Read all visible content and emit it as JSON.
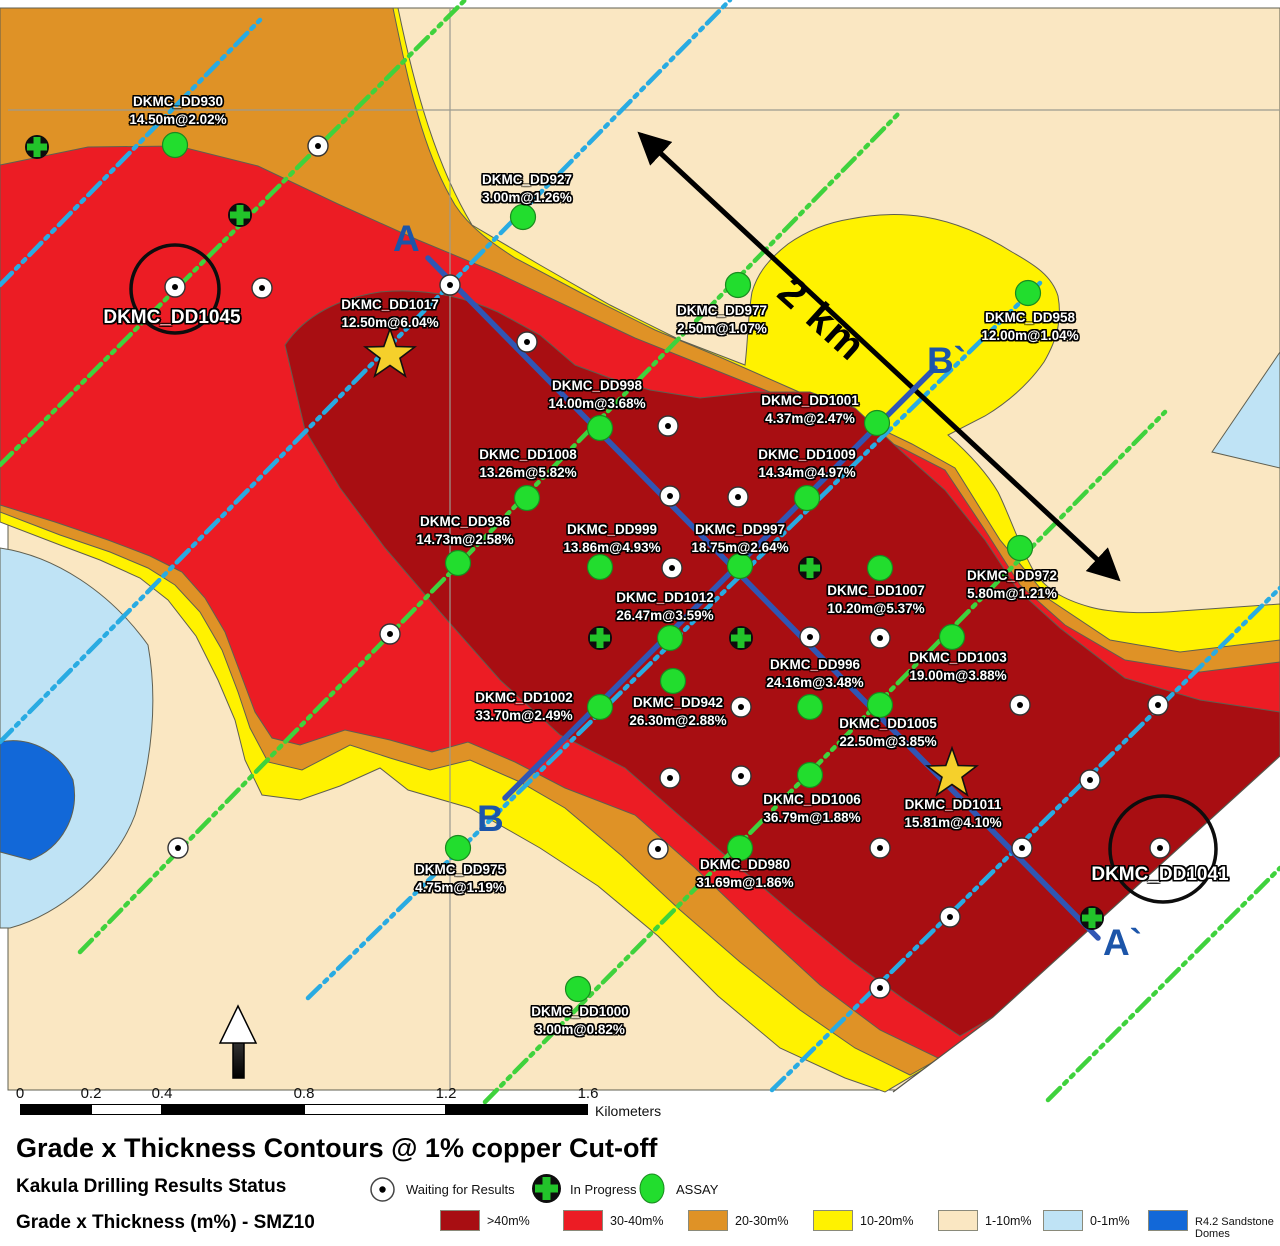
{
  "title": "Grade x Thickness Contours @ 1% copper Cut-off",
  "map": {
    "section_a": "A",
    "section_a_end": "A`",
    "section_b": "B",
    "section_b_end": "B`",
    "distance_label": "2 km"
  },
  "scalebar": {
    "ticks": [
      "0",
      "0.2",
      "0.4",
      "0.8",
      "1.2",
      "1.6"
    ],
    "unit": "Kilometers"
  },
  "holes": [
    {
      "id": "DKMC_DD930",
      "value": "14.50m@2.02%",
      "status": "assay"
    },
    {
      "id": "DKMC_DD927",
      "value": "3.00m@1.26%",
      "status": "assay"
    },
    {
      "id": "DKMC_DD977",
      "value": "2.50m@1.07%",
      "status": "assay"
    },
    {
      "id": "DKMC_DD958",
      "value": "12.00m@1.04%",
      "status": "assay"
    },
    {
      "id": "DKMC_DD1017",
      "value": "12.50m@6.04%",
      "status": "star"
    },
    {
      "id": "DKMC_DD1045",
      "value": "",
      "status": "waiting"
    },
    {
      "id": "DKMC_DD998",
      "value": "14.00m@3.68%",
      "status": "assay"
    },
    {
      "id": "DKMC_DD1001",
      "value": "4.37m@2.47%",
      "status": "assay"
    },
    {
      "id": "DKMC_DD1008",
      "value": "13.26m@5.82%",
      "status": "assay"
    },
    {
      "id": "DKMC_DD1009",
      "value": "14.34m@4.97%",
      "status": "assay"
    },
    {
      "id": "DKMC_DD936",
      "value": "14.73m@2.58%",
      "status": "assay"
    },
    {
      "id": "DKMC_DD999",
      "value": "13.86m@4.93%",
      "status": "assay"
    },
    {
      "id": "DKMC_DD997",
      "value": "18.75m@2.64%",
      "status": "assay"
    },
    {
      "id": "DKMC_DD1007",
      "value": "10.20m@5.37%",
      "status": "assay"
    },
    {
      "id": "DKMC_DD972",
      "value": "5.80m@1.21%",
      "status": "assay"
    },
    {
      "id": "DKMC_DD1012",
      "value": "26.47m@3.59%",
      "status": "assay"
    },
    {
      "id": "DKMC_DD1003",
      "value": "19.00m@3.88%",
      "status": "assay"
    },
    {
      "id": "DKMC_DD996",
      "value": "24.16m@3.48%",
      "status": "assay"
    },
    {
      "id": "DKMC_DD1002",
      "value": "33.70m@2.49%",
      "status": "assay"
    },
    {
      "id": "DKMC_DD942",
      "value": "26.30m@2.88%",
      "status": "assay"
    },
    {
      "id": "DKMC_DD1005",
      "value": "22.50m@3.85%",
      "status": "assay"
    },
    {
      "id": "DKMC_DD1006",
      "value": "36.79m@1.88%",
      "status": "assay"
    },
    {
      "id": "DKMC_DD1011",
      "value": "15.81m@4.10%",
      "status": "star"
    },
    {
      "id": "DKMC_DD975",
      "value": "4.75m@1.19%",
      "status": "assay"
    },
    {
      "id": "DKMC_DD980",
      "value": "31.69m@1.86%",
      "status": "assay"
    },
    {
      "id": "DKMC_DD1041",
      "value": "",
      "status": "waiting"
    },
    {
      "id": "DKMC_DD1000",
      "value": "3.00m@0.82%",
      "status": "assay"
    }
  ],
  "legend_status": {
    "heading": "Kakula Drilling Results Status",
    "items": [
      {
        "label": "Waiting for Results",
        "symbol": "white-dot-circle"
      },
      {
        "label": "In Progress",
        "symbol": "green-cross"
      },
      {
        "label": "ASSAY",
        "symbol": "green-circle"
      }
    ]
  },
  "legend_gt": {
    "heading": "Grade x Thickness (m%) - SMZ10",
    "items": [
      {
        "label": ">40m%",
        "color": "#a80e12"
      },
      {
        "label": "30-40m%",
        "color": "#ec1c24"
      },
      {
        "label": "20-30m%",
        "color": "#df9226"
      },
      {
        "label": "10-20m%",
        "color": "#fff200"
      },
      {
        "label": "1-10m%",
        "color": "#fae7c2"
      },
      {
        "label": "0-1m%",
        "color": "#bfe3f5"
      },
      {
        "label": "R4.2 Sandstone Domes",
        "color": "#1268d8"
      }
    ]
  }
}
